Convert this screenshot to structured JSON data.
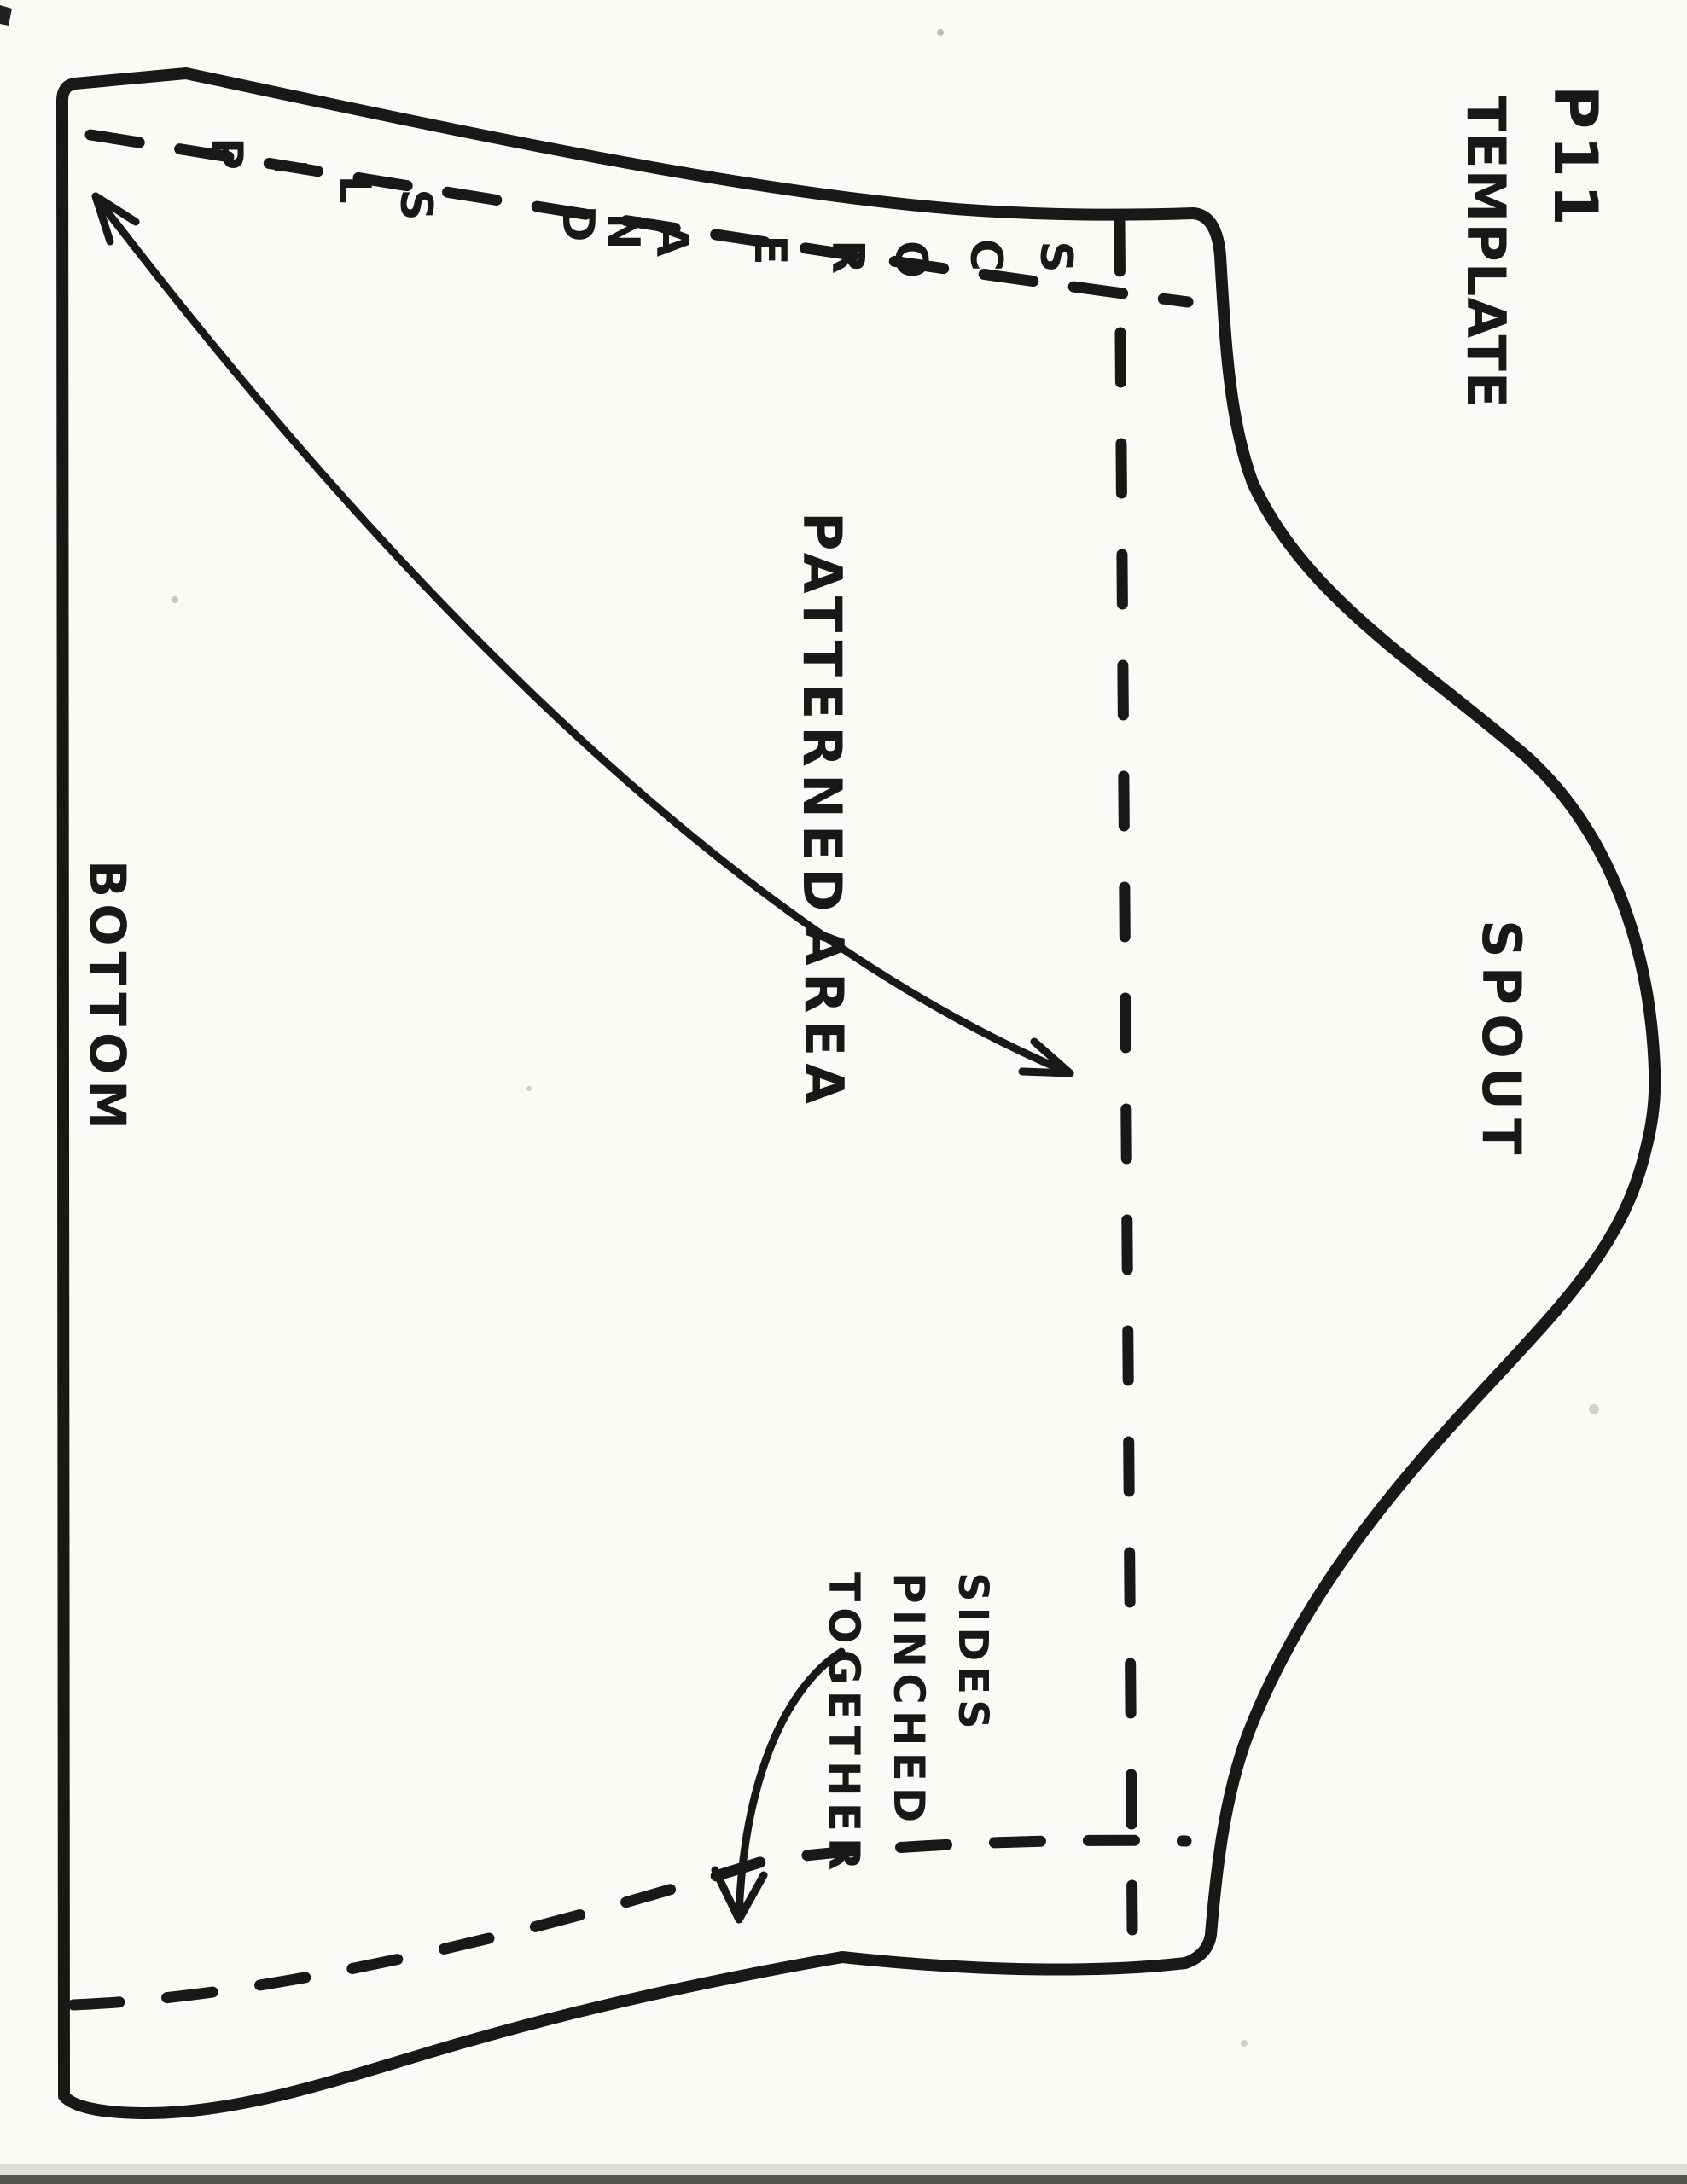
{
  "document_type": "scanned hand-drawn craft template sheet",
  "colors": {
    "paper": "#fafaf7",
    "ink": "#181818",
    "scan_strip": "#56544e"
  },
  "title": {
    "line1": "P11",
    "line2": "TEMPLATE"
  },
  "labels": {
    "bottom_edge": "BOTTOM",
    "patterned_word1": "PATTERNED",
    "patterned_word2": "AREA",
    "spout": "SPOUT",
    "pinch_line1": "SIDES",
    "pinch_line2": "PINCHED",
    "pinch_line3": "TOGETHER"
  },
  "score_slip": {
    "text": "SCORE AND SLIP",
    "letters_display": [
      "P",
      "I",
      "L",
      "S",
      "D",
      "N",
      "A",
      "E",
      "R",
      "O",
      "C",
      "S"
    ]
  }
}
